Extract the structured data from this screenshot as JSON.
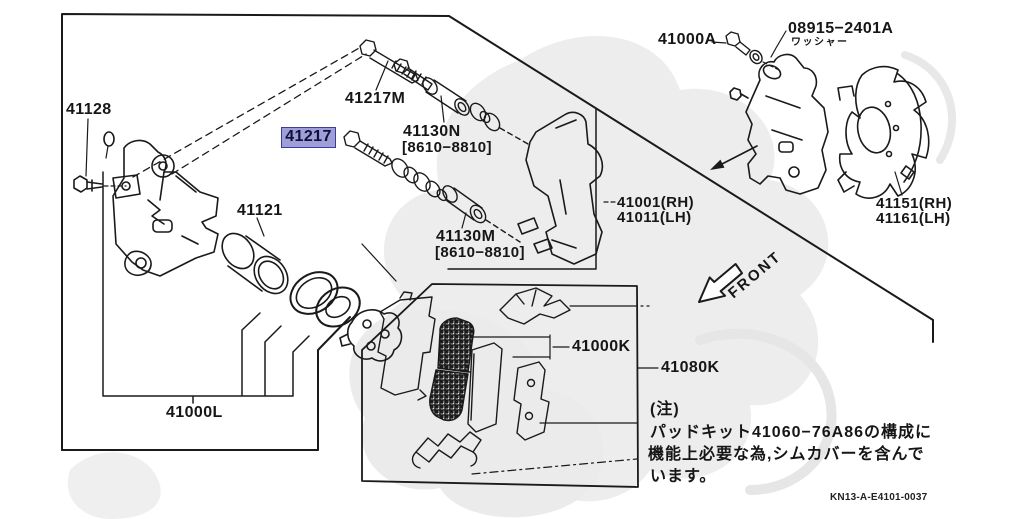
{
  "parts": {
    "n41128": "41128",
    "n41217m": "41217M",
    "n41217": "41217",
    "n41130n": "41130N",
    "n41130n_range": "[8610−8810]",
    "n41121": "41121",
    "n41130m": "41130M",
    "n41130m_range": "[8610−8810]",
    "n41000l": "41000L",
    "n41000a": "41000A",
    "n08915": "08915−2401A",
    "n08915_caption": "ワッシャー",
    "n41001rh": "41001(RH)",
    "n41011lh": "41011(LH)",
    "n41151rh": "41151(RH)",
    "n41161lh": "41161(LH)",
    "n41000k": "41000K",
    "n41080k": "41080K"
  },
  "selected_part": "41217",
  "front_arrow_label": "FRONT",
  "note": {
    "heading": "(注)",
    "line1": "パッドキット41060−76A86の構成に",
    "line2": "機能上必要な為,シムカバーを含んで",
    "line3": "います。"
  },
  "drawing_code": "KN13-A-E4101-0037",
  "colors": {
    "highlight_fill": "#9e9ed8",
    "highlight_border": "#3d3d99",
    "highlight_text": "#0f0f38",
    "line": "#1a1a1a",
    "background": "#ffffff",
    "watermark": "#ececec"
  },
  "highlight_css": "background:#9e9ed8;border:1.6px solid #3d3d99;color:#0f0f38"
}
